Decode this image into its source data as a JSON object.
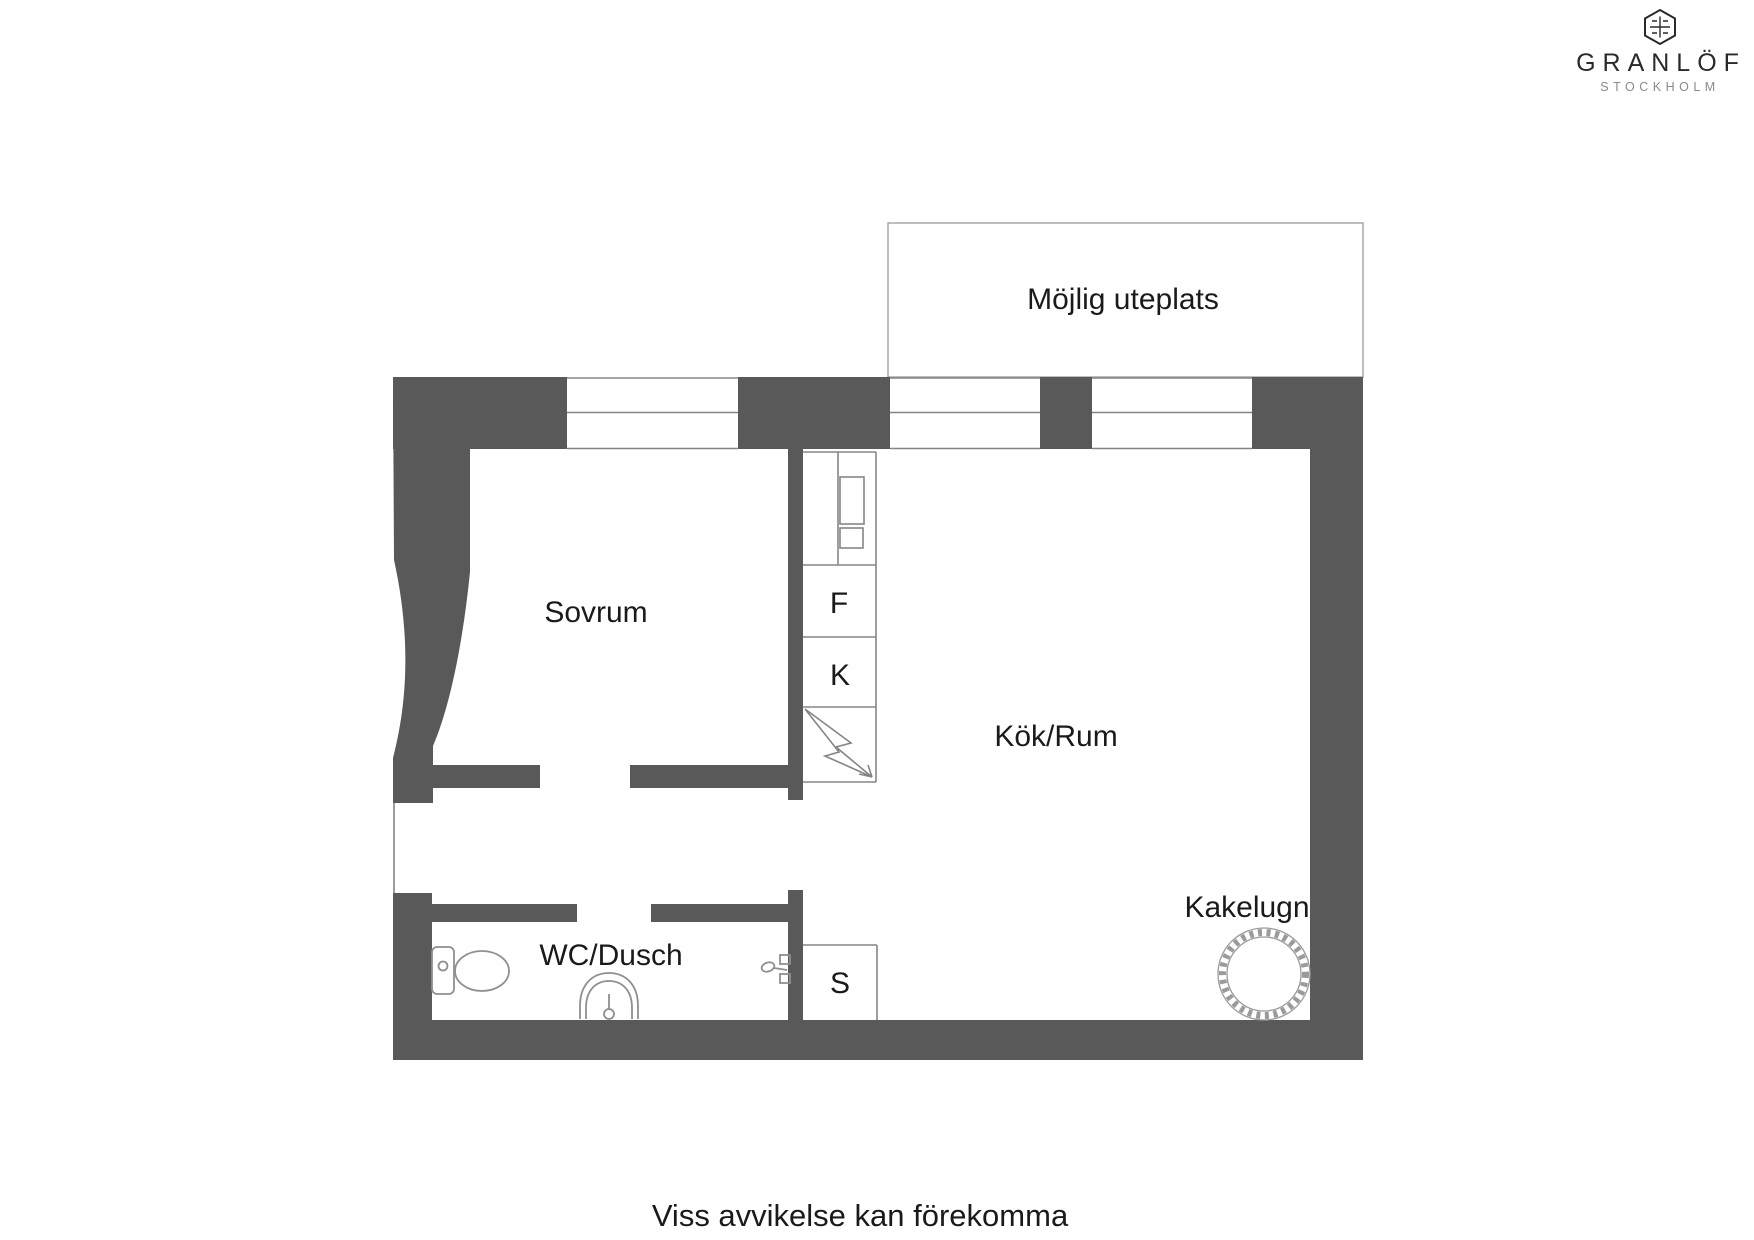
{
  "page": {
    "footer_note": "Viss avvikelse kan förekomma",
    "background_color": "#ffffff"
  },
  "logo": {
    "name": "GRANLÖF",
    "city": "STOCKHOLM",
    "mark": "hexagon-crest-icon"
  },
  "floor_plan": {
    "wall_color": "#595959",
    "line_color": "#858585",
    "text_color": "#1a1a1a",
    "labels": {
      "outdoor_area": "Möjlig uteplats",
      "bedroom": "Sovrum",
      "fridge": "F",
      "freezer": "K",
      "kitchen_room": "Kök/Rum",
      "bathroom": "WC/Dusch",
      "closet": "S",
      "tiled_stove": "Kakelugn"
    },
    "symbols": [
      "window-symbol",
      "toilet-icon",
      "sink-icon",
      "shower-mixer-icon",
      "electrical-bolt-icon",
      "tiled-stove-icon",
      "kitchen-counter-icon"
    ]
  }
}
